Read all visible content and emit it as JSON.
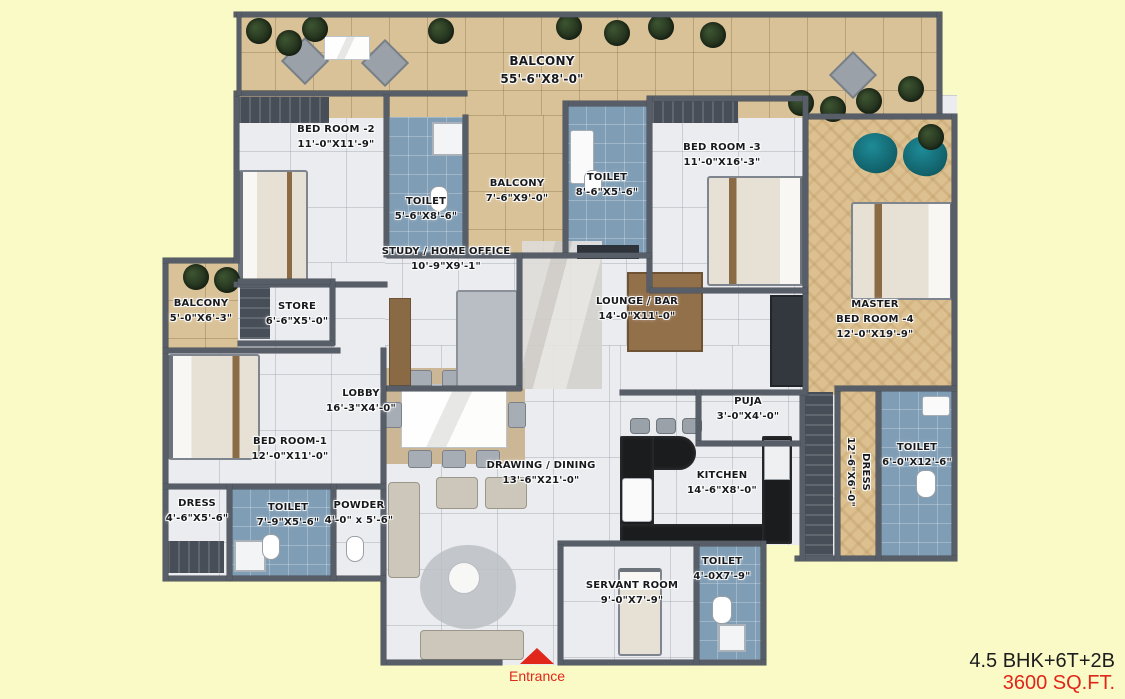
{
  "page": {
    "background_color": "#FAFAC6",
    "type": "apartment-floor-plan"
  },
  "footer": {
    "plan_type": "4.5 BHK+6T+2B",
    "plan_area": "3600 SQ.FT."
  },
  "entrance": {
    "label": "Entrance",
    "marker": "red-up-arrow"
  },
  "colors": {
    "wall": "#575E68",
    "floor_tile": "#EAECEF",
    "balcony_tile": "#D9C298",
    "bathroom_tile": "#7F9DB5",
    "wood_floor": "#DCC08F",
    "kitchen_counter": "#1B1C1E",
    "plant_green": "#2C3B24",
    "accent_red": "#E1261C",
    "teal_chair": "#17747F"
  },
  "rooms": [
    {
      "name": "BALCONY",
      "dims": "55'-6\"X8'-0\""
    },
    {
      "name": "BED ROOM -2",
      "dims": "11'-0\"X11'-9\""
    },
    {
      "name": "TOILET",
      "dims": "5'-6\"X8'-6\""
    },
    {
      "name": "BALCONY",
      "dims": "7'-6\"X9'-0\""
    },
    {
      "name": "TOILET",
      "dims": "8'-6\"X5'-6\""
    },
    {
      "name": "BED ROOM -3",
      "dims": "11'-0\"X16'-3\""
    },
    {
      "name": "MASTER",
      "name2": "BED ROOM -4",
      "dims": "12'-0\"X19'-9\""
    },
    {
      "name": "STUDY / HOME OFFICE",
      "dims": "10'-9\"X9'-1\""
    },
    {
      "name": "LOUNGE / BAR",
      "dims": "14'-0\"X11'-0\""
    },
    {
      "name": "BALCONY",
      "dims": "5'-0\"X6'-3\""
    },
    {
      "name": "STORE",
      "dims": "6'-6\"X5'-0\""
    },
    {
      "name": "LOBBY",
      "dims": "16'-3\"X4'-0\""
    },
    {
      "name": "BED ROOM-1",
      "dims": "12'-0\"X11'-0\""
    },
    {
      "name": "DRESS",
      "dims": "4'-6\"X5'-6\""
    },
    {
      "name": "TOILET",
      "dims": "7'-9\"X5'-6\""
    },
    {
      "name": "POWDER",
      "dims": "4'-0\" x 5'-6\""
    },
    {
      "name": "DRAWING / DINING",
      "dims": "13'-6\"X21'-0\""
    },
    {
      "name": "KITCHEN",
      "dims": "14'-6\"X8'-0\""
    },
    {
      "name": "PUJA",
      "dims": "3'-0\"X4'-0\""
    },
    {
      "name": "DRESS",
      "dims": "12'-6\"X6'-0\"",
      "orientation": "vertical"
    },
    {
      "name": "TOILET",
      "dims": "6'-0\"X12'-6\""
    },
    {
      "name": "SERVANT ROOM",
      "dims": "9'-0\"X7'-9\""
    },
    {
      "name": "TOILET",
      "dims": "4'-0X7'-9\""
    }
  ]
}
